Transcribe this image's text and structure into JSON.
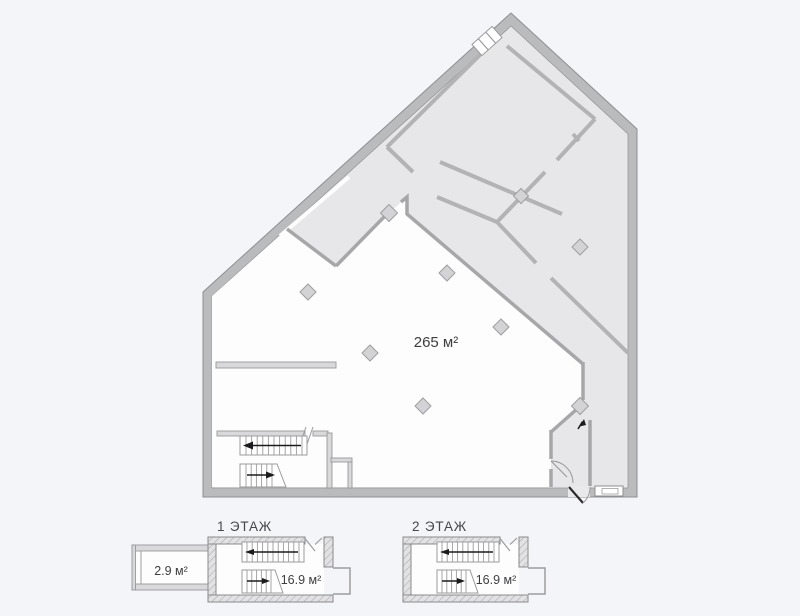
{
  "main_plan": {
    "area_label": "265 м²"
  },
  "floor_plans": [
    {
      "title": "1 ЭТАЖ",
      "area_label": "16.9 м²",
      "annex_area_label": "2.9 м²"
    },
    {
      "title": "2 ЭТАЖ",
      "area_label": "16.9 м²"
    }
  ],
  "colors": {
    "background": "#f4f5f8",
    "exterior_wall": "#babbbd",
    "wall_edge": "#8e8f91",
    "room_fill": "#e7e7e9",
    "open_floor": "#fdfdfe",
    "thin_wall": "#b3b3b5",
    "text": "#3e3e40",
    "arrow": "#1b1b1d"
  }
}
